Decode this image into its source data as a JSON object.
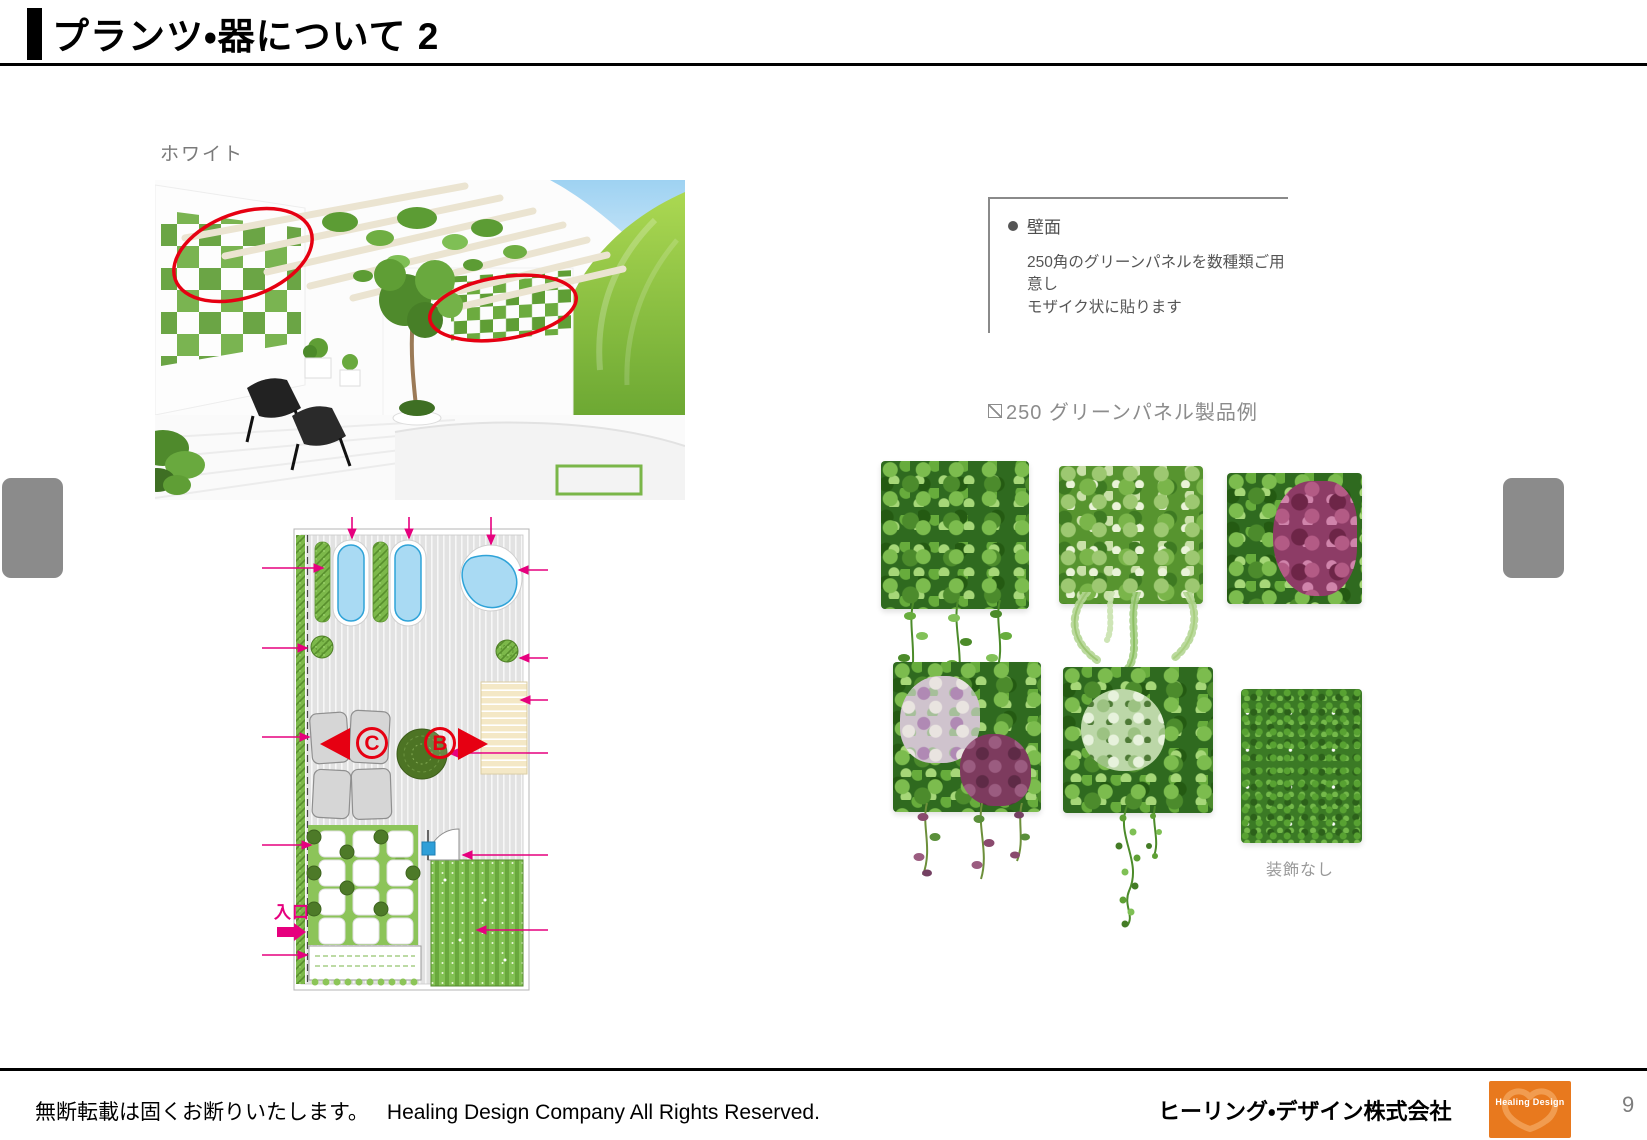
{
  "header": {
    "title": "プランツ・器について 2"
  },
  "left_column": {
    "variant_label": "ホワイト",
    "render_image": "white-terrace-garden-render",
    "floor_plan": {
      "marker_c": "C",
      "marker_b": "B",
      "entrance_label": "入口"
    }
  },
  "right_column": {
    "wall_note": {
      "bullet_icon": "filled-circle-icon",
      "heading": "壁面",
      "line1": "250角のグリーンパネルを数種類ご用意し",
      "line2": "モザイク状に貼ります"
    },
    "products_heading_icon": "square-diagonal-icon",
    "products_heading": "250 グリーンパネル製品例",
    "panels": [
      {
        "name": "pothos-green-panel"
      },
      {
        "name": "fern-green-panel"
      },
      {
        "name": "coleus-green-panel"
      },
      {
        "name": "fittonia-purple-green-panel"
      },
      {
        "name": "trailing-vine-green-panel"
      },
      {
        "name": "plain-grass-green-panel",
        "caption": "装飾なし"
      }
    ]
  },
  "footer": {
    "notice_jp": "無断転載は固くお断りいたします。",
    "notice_en": "Healing Design Company All Rights Reserved.",
    "company_name": "ヒーリング・デザイン株式会社",
    "logo_text": "Healing Design",
    "page_number": "9"
  },
  "colors": {
    "annotation_red": "#e60012",
    "annotation_magenta": "#e6007e",
    "logo_orange": "#e8791e",
    "pool_blue": "#a9daf3",
    "hedge_green": "#7cb84a",
    "gray_button": "#8b8b8b"
  }
}
